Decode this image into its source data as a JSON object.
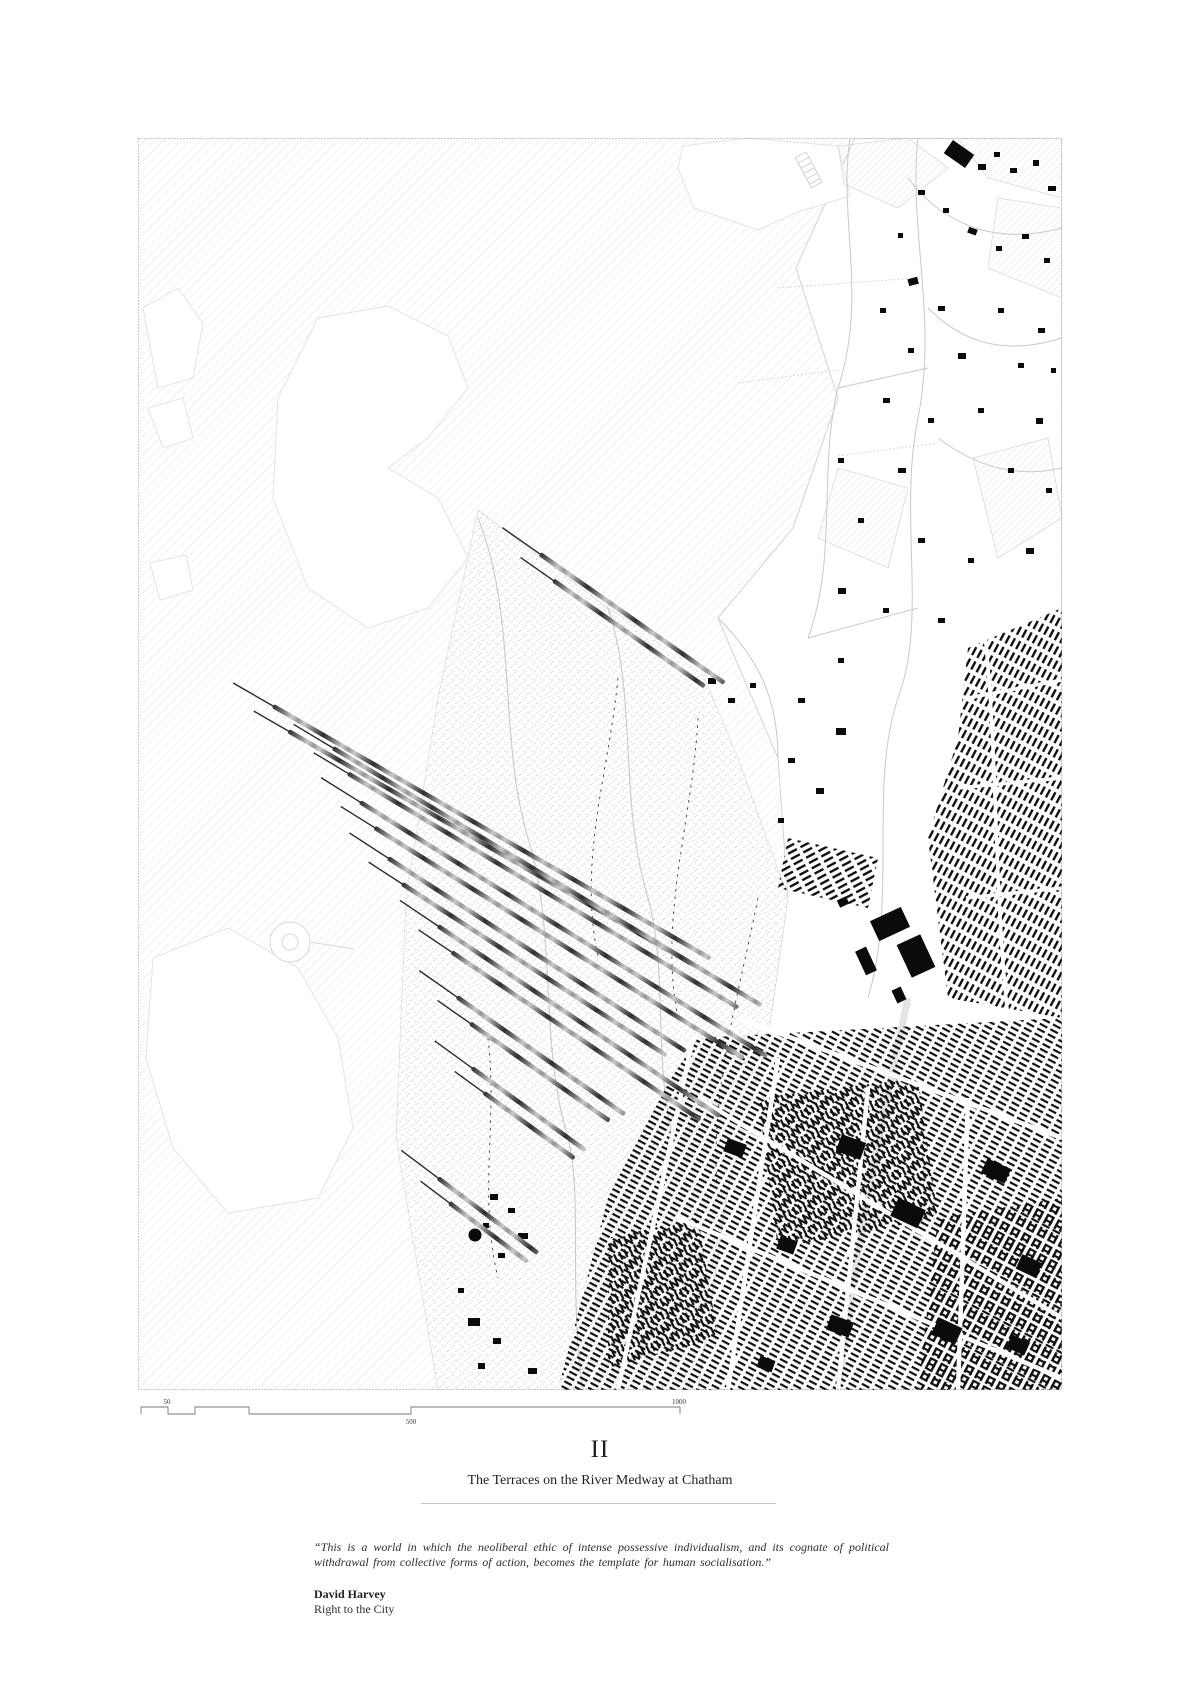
{
  "page": {
    "background": "#ffffff"
  },
  "map": {
    "description": "figure-ground-map-of-chatham-river-medway",
    "colors": {
      "water_hatch": "#dcdcdc",
      "field_hatch": "#d6d6d6",
      "land": "#ffffff",
      "buildings": "#0b0b0b",
      "roads": "#c9c9c9",
      "marsh_stipple": "#8c8c8c",
      "terrace_dark": "#2f2f2f",
      "terrace_light": "#c9c9c9",
      "border": "#9a9a9a"
    }
  },
  "scale_bar": {
    "labels": [
      {
        "text": "50"
      },
      {
        "text": "500"
      },
      {
        "text": "1000"
      }
    ]
  },
  "plate": {
    "number": "II",
    "title": "The Terraces on the River Medway at Chatham"
  },
  "quote": {
    "text": "“This is a world in which the neoliberal ethic of intense possessive individualism, and its cognate of political withdrawal from collective forms of action, becomes the template for human socialisation.”",
    "author": "David Harvey",
    "source": "Right to the City"
  }
}
